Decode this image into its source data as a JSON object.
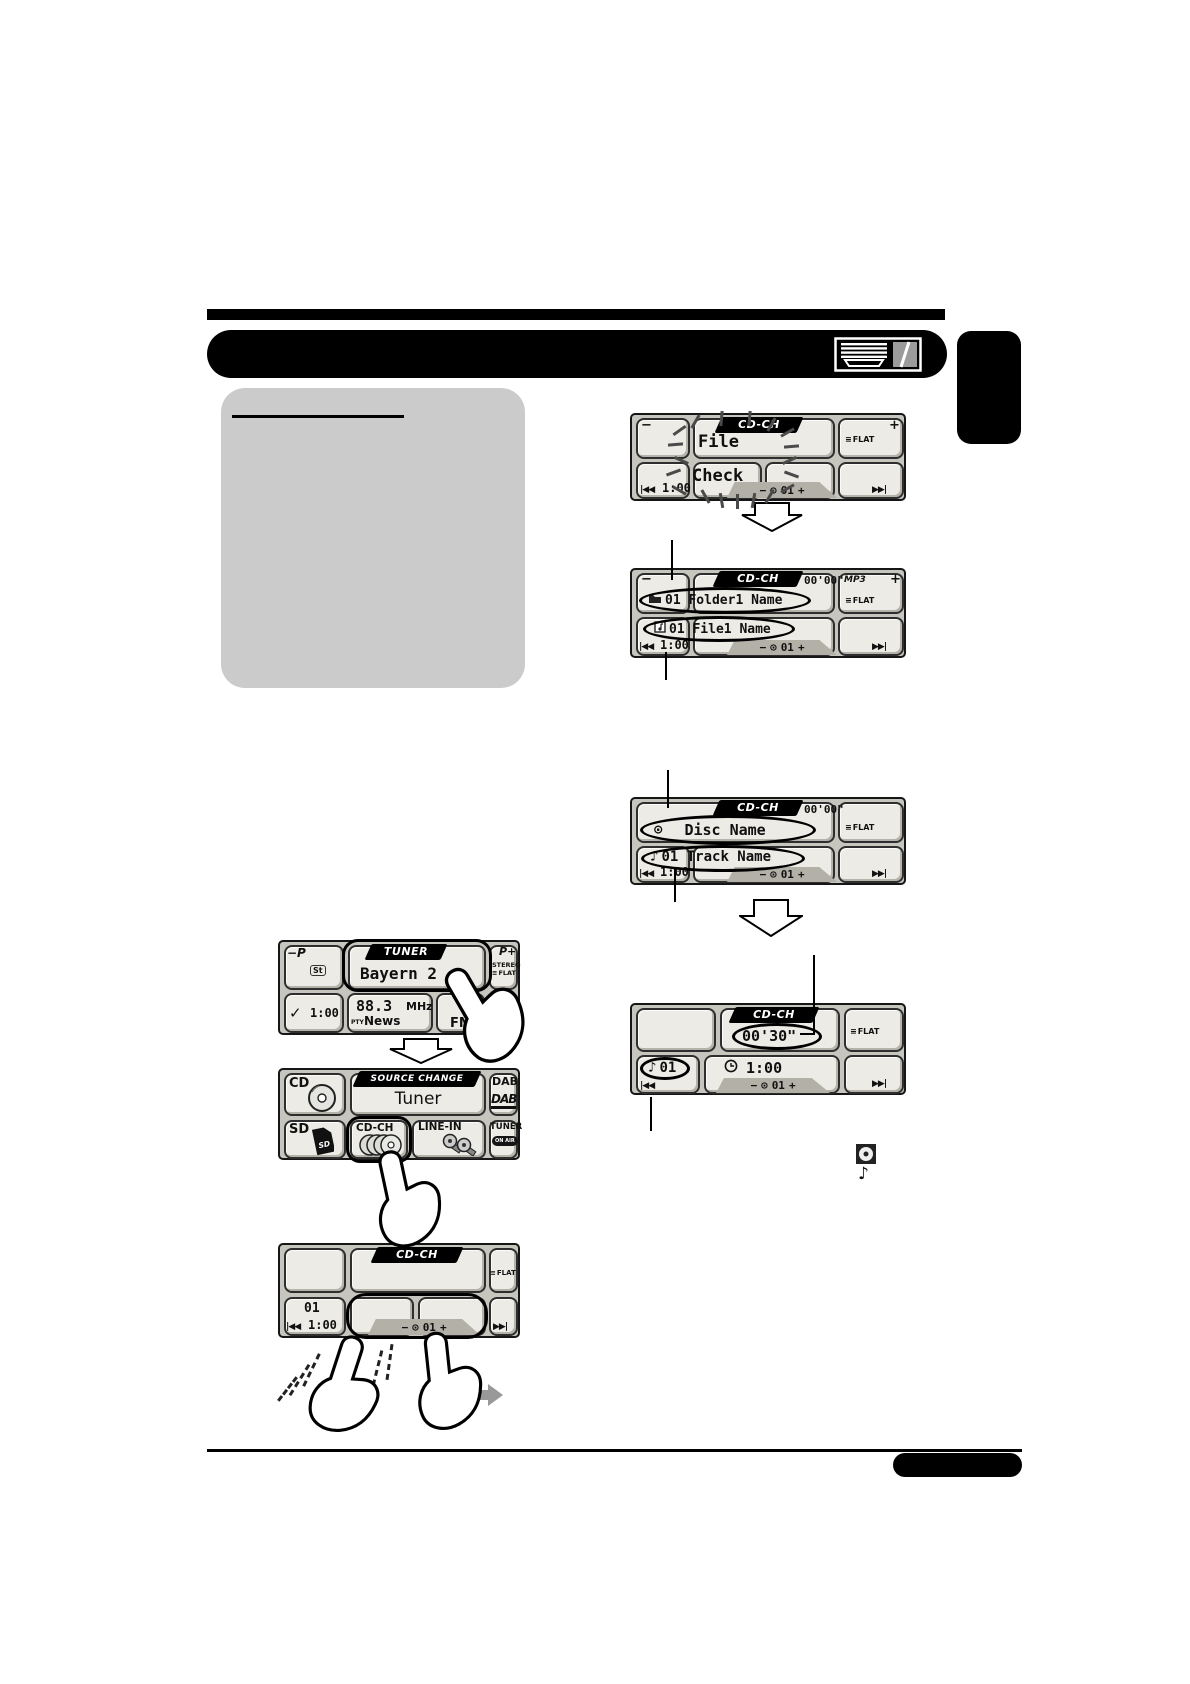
{
  "icons": {
    "prev": "|◀◀",
    "next": "▶▶|",
    "eq": "≡",
    "disc": "⊙",
    "note": "♪",
    "minus": "−",
    "plus": "+",
    "check_down": "✓",
    "chevron_up": "∧"
  },
  "d1": {
    "banner": "CD-CH",
    "flash_line1": "File",
    "flash_line2": "Check",
    "corner_minus": "−",
    "corner_plus": "+",
    "eq_label": "FLAT",
    "time": "1:00",
    "track_num": "01"
  },
  "d2": {
    "banner": "CD-CH",
    "elapsed": "00'00\"",
    "corner_minus": "−",
    "corner_plus": "+",
    "mp3_badge": "MP3",
    "eq_label": "FLAT",
    "folder_line": "01 Folder1 Name",
    "file_line": "01 File1 Name",
    "time": "1:00",
    "track_num": "01"
  },
  "d3": {
    "banner": "CD-CH",
    "elapsed": "00'00\"",
    "eq_label": "FLAT",
    "disc_line": "Disc Name",
    "track_line": "01 Track Name",
    "time": "1:00",
    "track_num": "01"
  },
  "d4": {
    "banner": "CD-CH",
    "elapsed": "00'30\"",
    "eq_label": "FLAT",
    "track_badge": "01",
    "time": "1:00",
    "track_num": "01"
  },
  "tuner": {
    "preset_down": "−P",
    "st_badge": "St",
    "banner": "TUNER",
    "station": "Bayern 2",
    "preset_up": "P+",
    "stereo": "STEREO",
    "eq_label": "FLAT",
    "time": "1:00",
    "freq": "88.3",
    "freq_unit": "MHz",
    "pty_label": "PTY",
    "pty_value": "News",
    "band": "FM",
    "af_badge": "AF"
  },
  "source": {
    "banner": "SOURCE CHANGE",
    "current": "Tuner",
    "cd": "CD",
    "dab": "DAB",
    "dab_logo": "DAB",
    "sd": "SD",
    "sd_card_label": "SD",
    "cd_ch": "CD-CH",
    "line_in": "LINE-IN",
    "tuner": "TUNER",
    "onair_badge": "ON AIR"
  },
  "d6": {
    "banner": "CD-CH",
    "eq_label": "FLAT",
    "disc_num": "01",
    "time": "1:00",
    "track_num": "01"
  }
}
